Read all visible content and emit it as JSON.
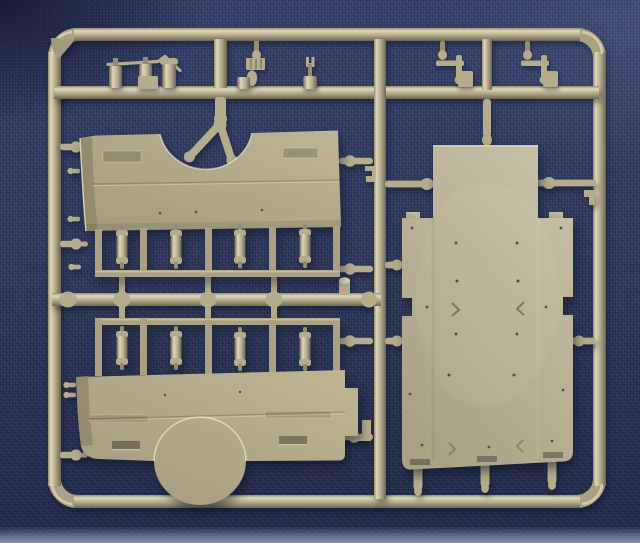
{
  "scene": {
    "subject": "injection-moulded model kit sprue of tan plastic parts",
    "background": "dark blue fabric cloth",
    "lighting": "soft daylight from upper right, shadows cast down-left"
  },
  "colors": {
    "bgBase": "#35406a",
    "bgMid": "#2e3759",
    "bgDark": "#1f2847",
    "bgBottomGlow": "#96a3c9",
    "vignette": "rgba(8,12,30,0.55)",
    "plastic": "#aaa184",
    "plasticHi": "#ded8b8",
    "plasticMid": "#b5ac8d",
    "plasticLo": "#6e6751",
    "runTop": "#948c70",
    "panelLight": "#bdb593",
    "panelShade": "#a39b7d",
    "panelEdge": "#8f876b",
    "panelEdgeHi": "#d9d3b3",
    "plateHi": "#c6c0a4",
    "plateLo": "#a8a186",
    "holeDark": "#564f3c",
    "detailDark": "rgba(62,56,36,0.5)",
    "detailLight": "rgba(255,250,224,0.55)",
    "shadow": "rgba(9,13,30,0.5)",
    "shadowSoft": "rgba(9,13,30,0.42)"
  },
  "sprue": {
    "frame": "rounded rectangular runner frame with internal runners",
    "parts": [
      {
        "name": "corner-gusset-plate",
        "count": 1
      },
      {
        "name": "linkage-rod-with-three-cylinders",
        "count": 1
      },
      {
        "name": "ribbed-block-with-pin",
        "count": 1
      },
      {
        "name": "cone-tipped-cylinder",
        "count": 1
      },
      {
        "name": "fork-pin-cylinder",
        "count": 1
      },
      {
        "name": "hinge-bracket-assembly",
        "count": 2
      },
      {
        "name": "upper-hull-side-panel-with-arch-notch",
        "count": 1
      },
      {
        "name": "lower-hull-side-panel-with-wheel-arch",
        "count": 1
      },
      {
        "name": "shock-absorber-cylinder",
        "count": 8
      },
      {
        "name": "hull-floor-plate",
        "count": 1
      },
      {
        "name": "ball-end-attachment-stub",
        "count": 14
      }
    ]
  }
}
